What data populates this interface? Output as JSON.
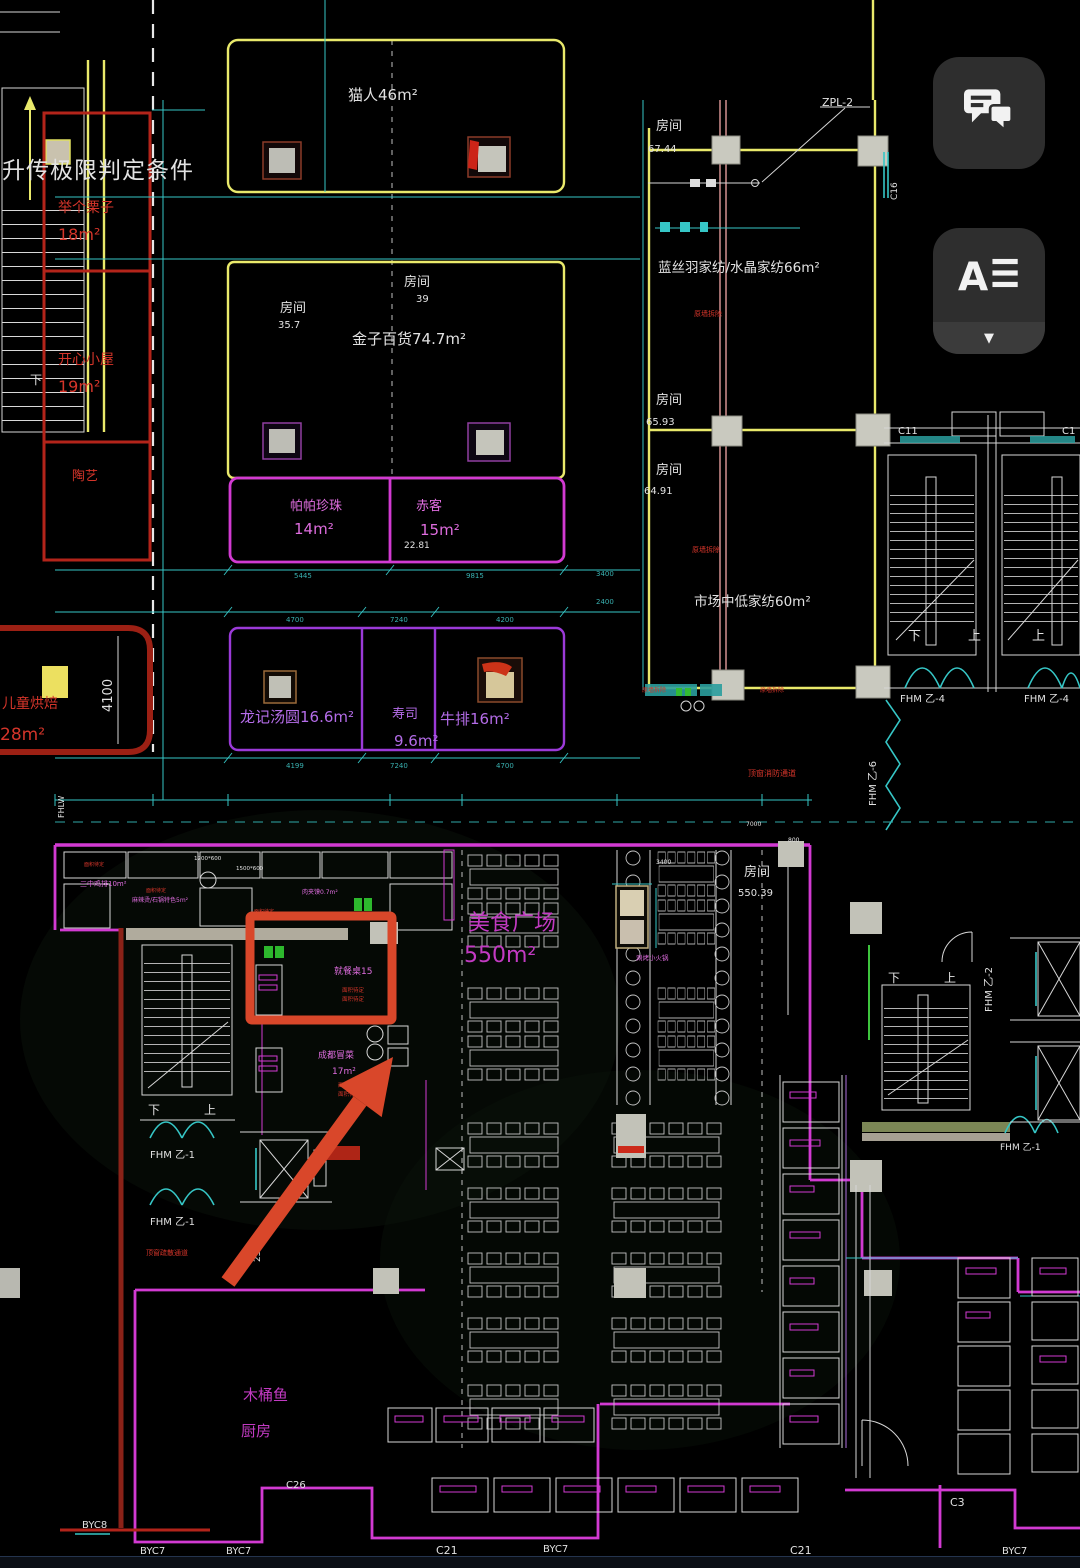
{
  "ui": {
    "chat_button_icon": "chat-bubbles",
    "text_button_label": "A",
    "text_button_icon": "text-align-lines",
    "text_button_caret": "▼",
    "annotation_color": "#d9472a"
  },
  "plan": {
    "overlay_text": "升传极限判定条件",
    "labels": {
      "maoren": "猫人46m²",
      "room": "房间",
      "r39": "39",
      "r357": "35.7",
      "jinzi": "金子百货74.7m²",
      "papa": "帕帕珍珠",
      "papa_a": "14m²",
      "chike": "赤客",
      "chike_a": "15m²",
      "n2281": "22.81",
      "longji": "龙记汤圆16.6m²",
      "sushi": "寿司",
      "sushi_a": "9.6m²",
      "niupai": "牛排16m²",
      "juge": "举个栗子",
      "juge_a": "18m²",
      "kaixin": "开心小屋",
      "kaixin_a": "19m²",
      "taoyi": "陶艺",
      "ertong": "儿童烘焙",
      "ertong_a": "28m²",
      "lansiyu": "蓝丝羽家纺/水晶家纺66m²",
      "n6744": "67.44",
      "n6593": "65.93",
      "n6491": "64.91",
      "shichang": "市场中低家纺60m²",
      "yuanqiang": "原墙拆除",
      "xiaofang": "顶窗消防通道",
      "shusan": "顶窗疏散通道",
      "meishi": "美食广场",
      "meishi_a": "550m²",
      "n55039": "550.39",
      "huoguo": "涮烤小火锅",
      "highlight": "就餐桌15",
      "tbd": "面积待定",
      "maocai": "成都冒菜",
      "maocai_a": "17m²",
      "mutongyu": "木桶鱼",
      "chufang": "厨房",
      "jipai": "三中鸡排10m²",
      "malatang": "麻辣烫/石锅特色5m²",
      "roujiamo": "肉夹馍0.7m²",
      "xia": "下",
      "shang": "上"
    },
    "codes": {
      "zpl2": "ZPL-2",
      "c16": "C16",
      "c11": "C11",
      "c1": "C1",
      "fhm1": "FHM 乙-1",
      "fhm2": "FHM 乙-2",
      "fhm4": "FHM 乙-4",
      "fhm6": "FHM 乙-6",
      "fhlw": "FHLW",
      "byc8": "BYC8",
      "byc7": "BYC7",
      "c26": "C26",
      "c21": "C21",
      "c3": "C3"
    },
    "dims": {
      "d5445": "5445",
      "d9815": "9815",
      "d4700": "4700",
      "d7240": "7240",
      "d4200": "4200",
      "d4199": "4199",
      "d3400": "3400",
      "d2400": "2400",
      "d7000": "7000",
      "d800": "800",
      "d4100": "4100",
      "d2395": "2395",
      "d1200": "1200*600",
      "d1500": "1500*600"
    }
  }
}
